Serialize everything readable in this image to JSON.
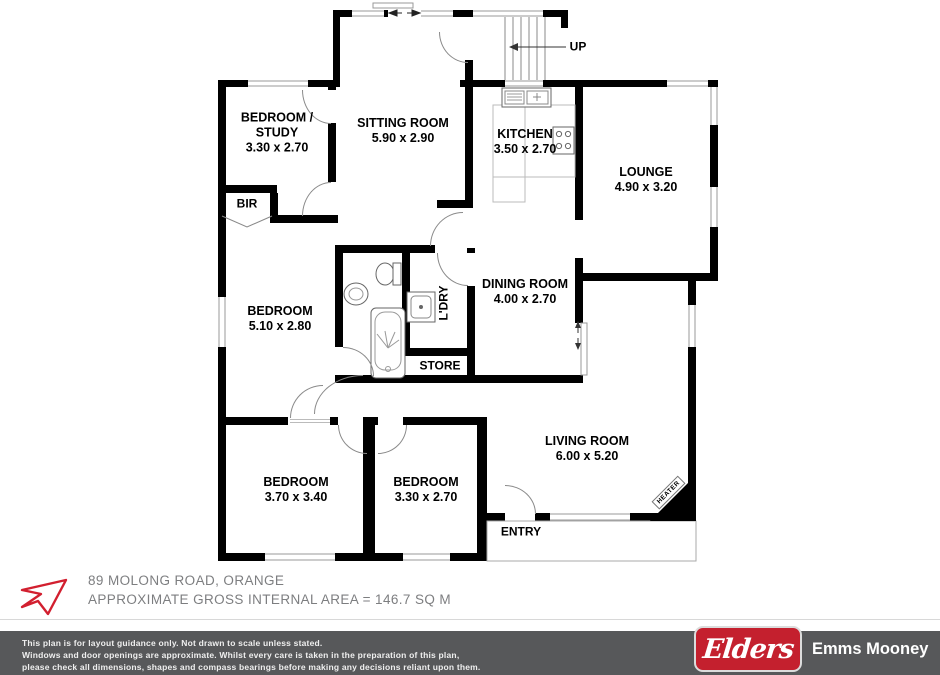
{
  "floor_plan": {
    "rooms": {
      "bedroom_study": {
        "name_line1": "BEDROOM /",
        "name_line2": "STUDY",
        "dims": "3.30 x 2.70"
      },
      "sitting_room": {
        "name": "SITTING ROOM",
        "dims": "5.90 x 2.90"
      },
      "kitchen": {
        "name": "KITCHEN",
        "dims": "3.50 x 2.70"
      },
      "lounge": {
        "name": "LOUNGE",
        "dims": "4.90 x 3.20"
      },
      "bedroom_middle": {
        "name": "BEDROOM",
        "dims": "5.10 x 2.80"
      },
      "dining_room": {
        "name": "DINING ROOM",
        "dims": "4.00 x 2.70"
      },
      "bedroom_left": {
        "name": "BEDROOM",
        "dims": "3.70 x 3.40"
      },
      "bedroom_center": {
        "name": "BEDROOM",
        "dims": "3.30 x 2.70"
      },
      "living_room": {
        "name": "LIVING ROOM",
        "dims": "6.00 x 5.20"
      }
    },
    "labels": {
      "bir": "BIR",
      "laundry": "L'DRY",
      "store": "STORE",
      "entry": "ENTRY",
      "up": "UP",
      "heater": "HEATER"
    }
  },
  "footer": {
    "address": "89 MOLONG ROAD, ORANGE",
    "area": "APPROXIMATE GROSS INTERNAL AREA = 146.7 SQ M"
  },
  "disclaimer": {
    "line1": "This plan is for layout guidance only. Not drawn to scale unless stated.",
    "line2": "Windows and door openings are approximate. Whilst every care is taken in the preparation of this plan,",
    "line3": "please check all dimensions, shapes and compass bearings before making any decisions reliant upon them."
  },
  "brand": {
    "logo_text": "Elders",
    "agency": "Emms Mooney"
  },
  "colors": {
    "wall": "#000000",
    "brand_red": "#c4202e",
    "footer_bar": "#57585a",
    "address_text": "#7d7e80"
  }
}
